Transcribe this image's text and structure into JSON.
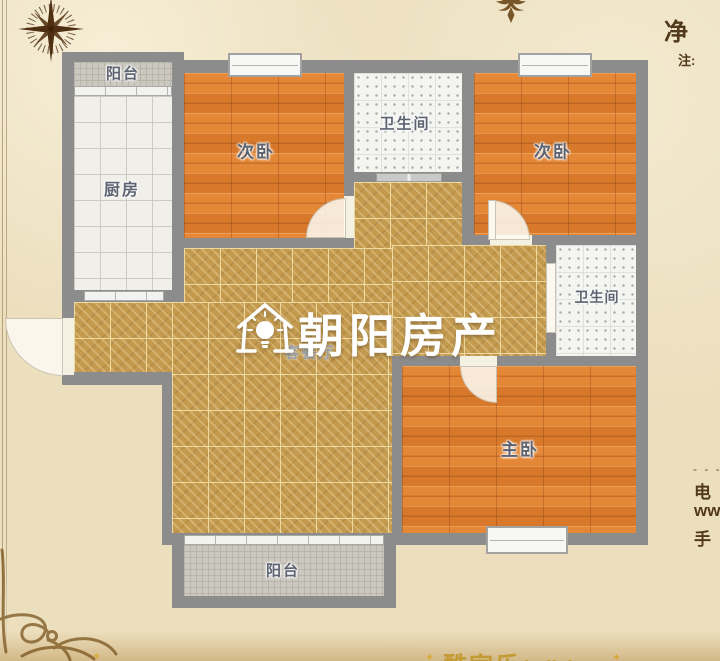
{
  "plan": {
    "rooms": [
      {
        "id": "balcony-top",
        "label": "阳台"
      },
      {
        "id": "kitchen",
        "label": "厨房"
      },
      {
        "id": "bedroom-left",
        "label": "次卧"
      },
      {
        "id": "bathroom-top",
        "label": "卫生间"
      },
      {
        "id": "bedroom-right",
        "label": "次卧"
      },
      {
        "id": "bathroom-right",
        "label": "卫生间"
      },
      {
        "id": "living-dining",
        "label": "客餐厅"
      },
      {
        "id": "master-bedroom",
        "label": "主卧"
      },
      {
        "id": "balcony-bottom",
        "label": "阳台"
      }
    ]
  },
  "watermark": {
    "brand": "朝阳房产",
    "icon": "house-bulb-icon"
  },
  "annotations": {
    "top_right_char": "净",
    "top_right_note": "注:",
    "right_dashes": "- - - -",
    "right_line_1": "电",
    "right_line_2": "ww",
    "right_line_3": "手"
  },
  "footer": {
    "brand_cn": "酷家乐",
    "brand_en": "kujiale.com",
    "star": "✦"
  },
  "colors": {
    "parchment": "#ecdfbe",
    "wall": "#8c8c8c",
    "wood_floor": "#df8030",
    "gold_tile": "#c39a4e",
    "label_text": "#5d6370",
    "watermark_text": "#ffffff",
    "footer_gold": "#c49a33",
    "ink_brown": "#52391b"
  }
}
